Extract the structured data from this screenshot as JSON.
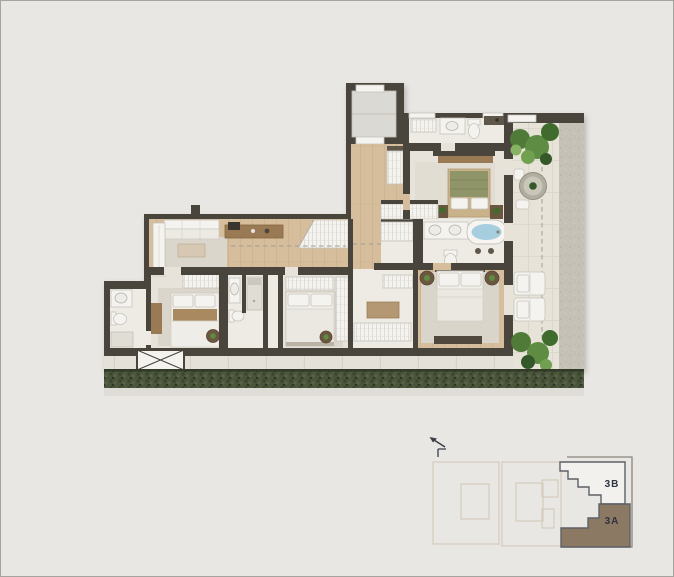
{
  "key_plan": {
    "units": [
      {
        "label": "3B",
        "fill": "#f2f1ed"
      },
      {
        "label": "3A",
        "fill": "#8c7963"
      }
    ]
  },
  "icons": {
    "north_arrow": "north-arrow-icon"
  },
  "colors": {
    "bg": "#e9e7e3",
    "border": "#a6a49f",
    "wall": "#49443c",
    "wood": "#d6bd9b",
    "wood_joint": "#c3a884",
    "carpet": "#e8e3da",
    "tile": "#edebe4",
    "rug": "#dbd6cc",
    "white_furn": "#f4f3ef",
    "cream_furn": "#eceae3",
    "furn_stroke": "#c6c3bb",
    "wood_furn": "#9a7a54",
    "wood_furn_dark": "#6b563f",
    "wood_furn_light": "#b39873",
    "console_dark": "#50483c",
    "counter_dark": "#5f574a",
    "olive_bed": "#8f9469",
    "tub_water": "#a7cedf",
    "terrace": "#e7e3d9",
    "terrace_joint": "#d8d4c9",
    "concrete": "#c5c1b6",
    "walkway": "#e4e1d8",
    "hedge": "#4a5438",
    "hedge_dark": "#323a28",
    "plant_1": "#4f7a38",
    "plant_2": "#5d8c42",
    "plant_3": "#3f6b2d",
    "plant_4": "#71a050",
    "plant_5": "#35582a",
    "plant_6": "#86b262",
    "dash": "#a39e92",
    "shower_glass": "#e0ddd5",
    "elevator_floor": "#dad9d4",
    "kp_outline": "#d5cbbc",
    "kp_shadow": "#8b867d",
    "kp_unit_stroke": "#5d6167",
    "kp_label": "#2d333f"
  }
}
